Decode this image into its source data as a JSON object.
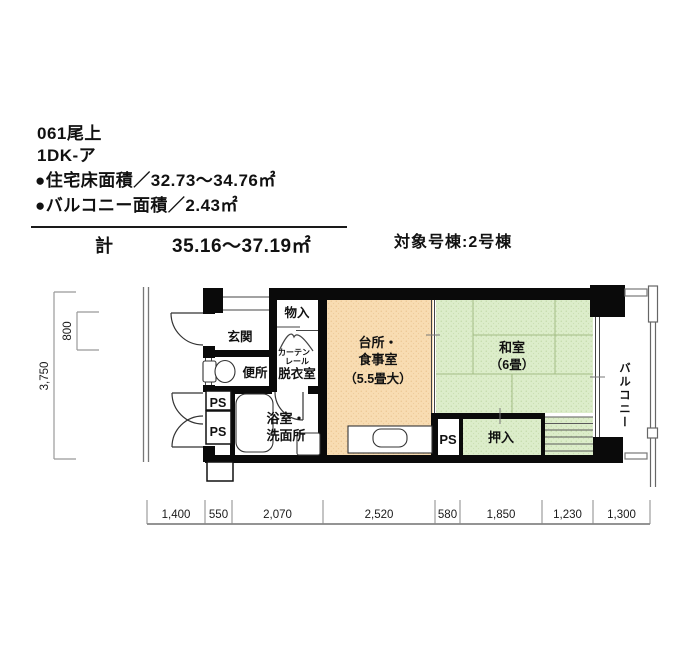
{
  "header": {
    "unit_code": "061尾上",
    "plan_type": "1DK-ア",
    "floor_area": "●住宅床面積／32.73〜34.76㎡",
    "balcony_area": "●バルコニー面積／2.43㎡",
    "total_label": "計",
    "total_value": "35.16〜37.19㎡",
    "target_building": "対象号棟:2号棟"
  },
  "rooms": {
    "genkan": "玄関",
    "storage": "物入",
    "toilet": "便所",
    "dressing_room": "脱衣室",
    "curtain_line1": "カーテン",
    "curtain_line2": "レール",
    "pipe_space": "PS",
    "bathroom_line1": "浴室・",
    "bathroom_line2": "洗面所",
    "kitchen_line1": "台所・",
    "kitchen_line2": "食事室",
    "kitchen_line3": "（5.5畳大）",
    "japanese_room_line1": "和室",
    "japanese_room_line2": "（6畳）",
    "closet": "押入",
    "balcony": "バルコニー"
  },
  "dimensions": {
    "vertical_total": "3,750",
    "vertical_entry": "800",
    "bottom": [
      "1,400",
      "550",
      "2,070",
      "2,520",
      "580",
      "1,850",
      "1,230",
      "1,300"
    ]
  },
  "colors": {
    "kitchen_fill": "#f8dcb2",
    "tatami_fill": "#dcedca",
    "wall": "#0a0a0a"
  }
}
